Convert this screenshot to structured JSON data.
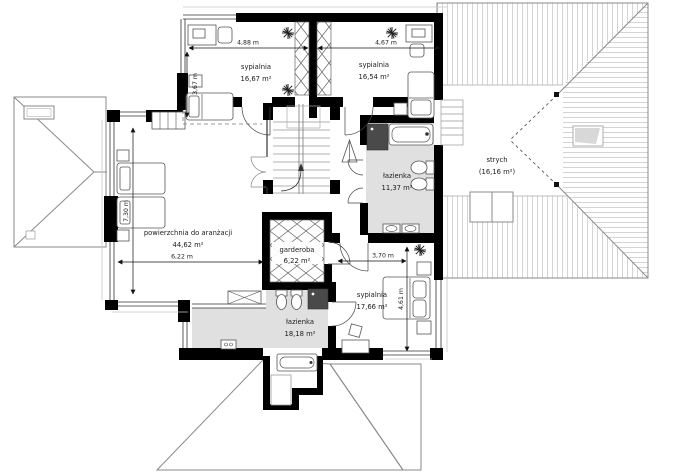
{
  "plan": {
    "rooms": {
      "bedroom_top_left": {
        "name": "sypialnia",
        "area": "16,67 m²"
      },
      "bedroom_top_right": {
        "name": "sypialnia",
        "area": "16,54 m²"
      },
      "bathroom_top": {
        "name": "łazienka",
        "area": "11,37 m²"
      },
      "attic": {
        "name": "strych",
        "area": "(16,16 m²)"
      },
      "arrangement_area": {
        "name": "powierzchnia do aranżacji",
        "area": "44,62 m²"
      },
      "wardrobe": {
        "name": "garderoba",
        "area": "6,22 m²"
      },
      "bedroom_bottom": {
        "name": "sypialnia",
        "area": "17,66 m²"
      },
      "bathroom_bottom": {
        "name": "łazienka",
        "area": "18,18 m²"
      }
    },
    "dimensions": {
      "bedroom_top_left_width": "4,88 m",
      "bedroom_top_left_depth": "3,67 m",
      "bedroom_top_right_width": "4,67 m",
      "arrangement_depth": "7,30 m",
      "arrangement_width": "6,22 m",
      "bedroom_bottom_width": "3,70 m",
      "bedroom_bottom_depth": "4,61 m"
    },
    "colors": {
      "wall": "#000000",
      "bath_floor": "#e0e0e0",
      "roof_hatch": "#c9c9c9",
      "shower": "#4a4a4a"
    }
  }
}
